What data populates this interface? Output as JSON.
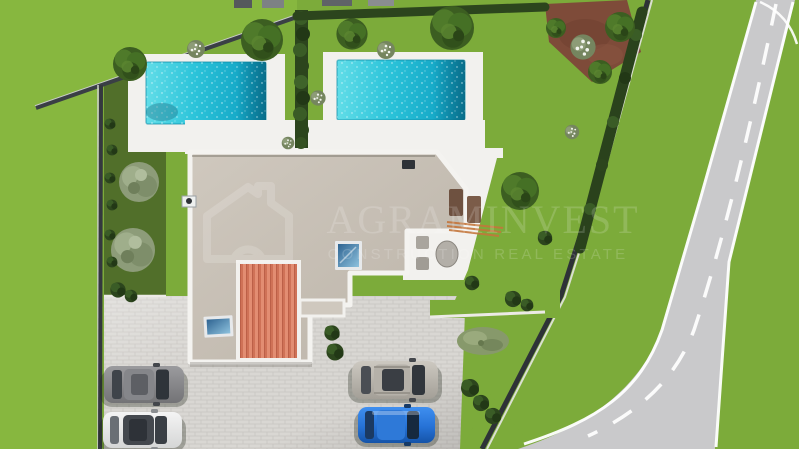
{
  "image": {
    "type": "aerial-3d-architectural-render",
    "view": "top-down",
    "subject": "Two modern villas with private pools, landscaped gardens, paved parking with four cars and an access road"
  },
  "watermark": {
    "logo": "house-outline-icon",
    "brand": "AGRAMINVEST",
    "tagline": "CONSTRUCTION REAL ESTATE"
  },
  "inventory": {
    "villas": 2,
    "pools": 2,
    "cars": 4,
    "car_colors": [
      "grey",
      "white",
      "silver",
      "blue"
    ]
  },
  "colors": {
    "lawn": "#7cab3a",
    "lawn_bright": "#87b73f",
    "garden_shade": "#516f2a",
    "pool_water": "#2cc4da",
    "pool_deck": "#f2f1ee",
    "flat_roof": "#c6bfb4",
    "parapet": "#f4f3f0",
    "tile_roof": "#cf7257",
    "driveway": "#d9d7d3",
    "road": "#c9c9cb",
    "road_marking": "#ffffff",
    "boundary_wall": "#34383e",
    "hedge": "#2c451d",
    "dirt_patch": "#7e4b39",
    "car_grey": "#8a8a8c",
    "car_white": "#e9eaea",
    "car_silver": "#b7b3ab",
    "car_blue": "#2f7fe0",
    "watermark": "#ffffff"
  }
}
